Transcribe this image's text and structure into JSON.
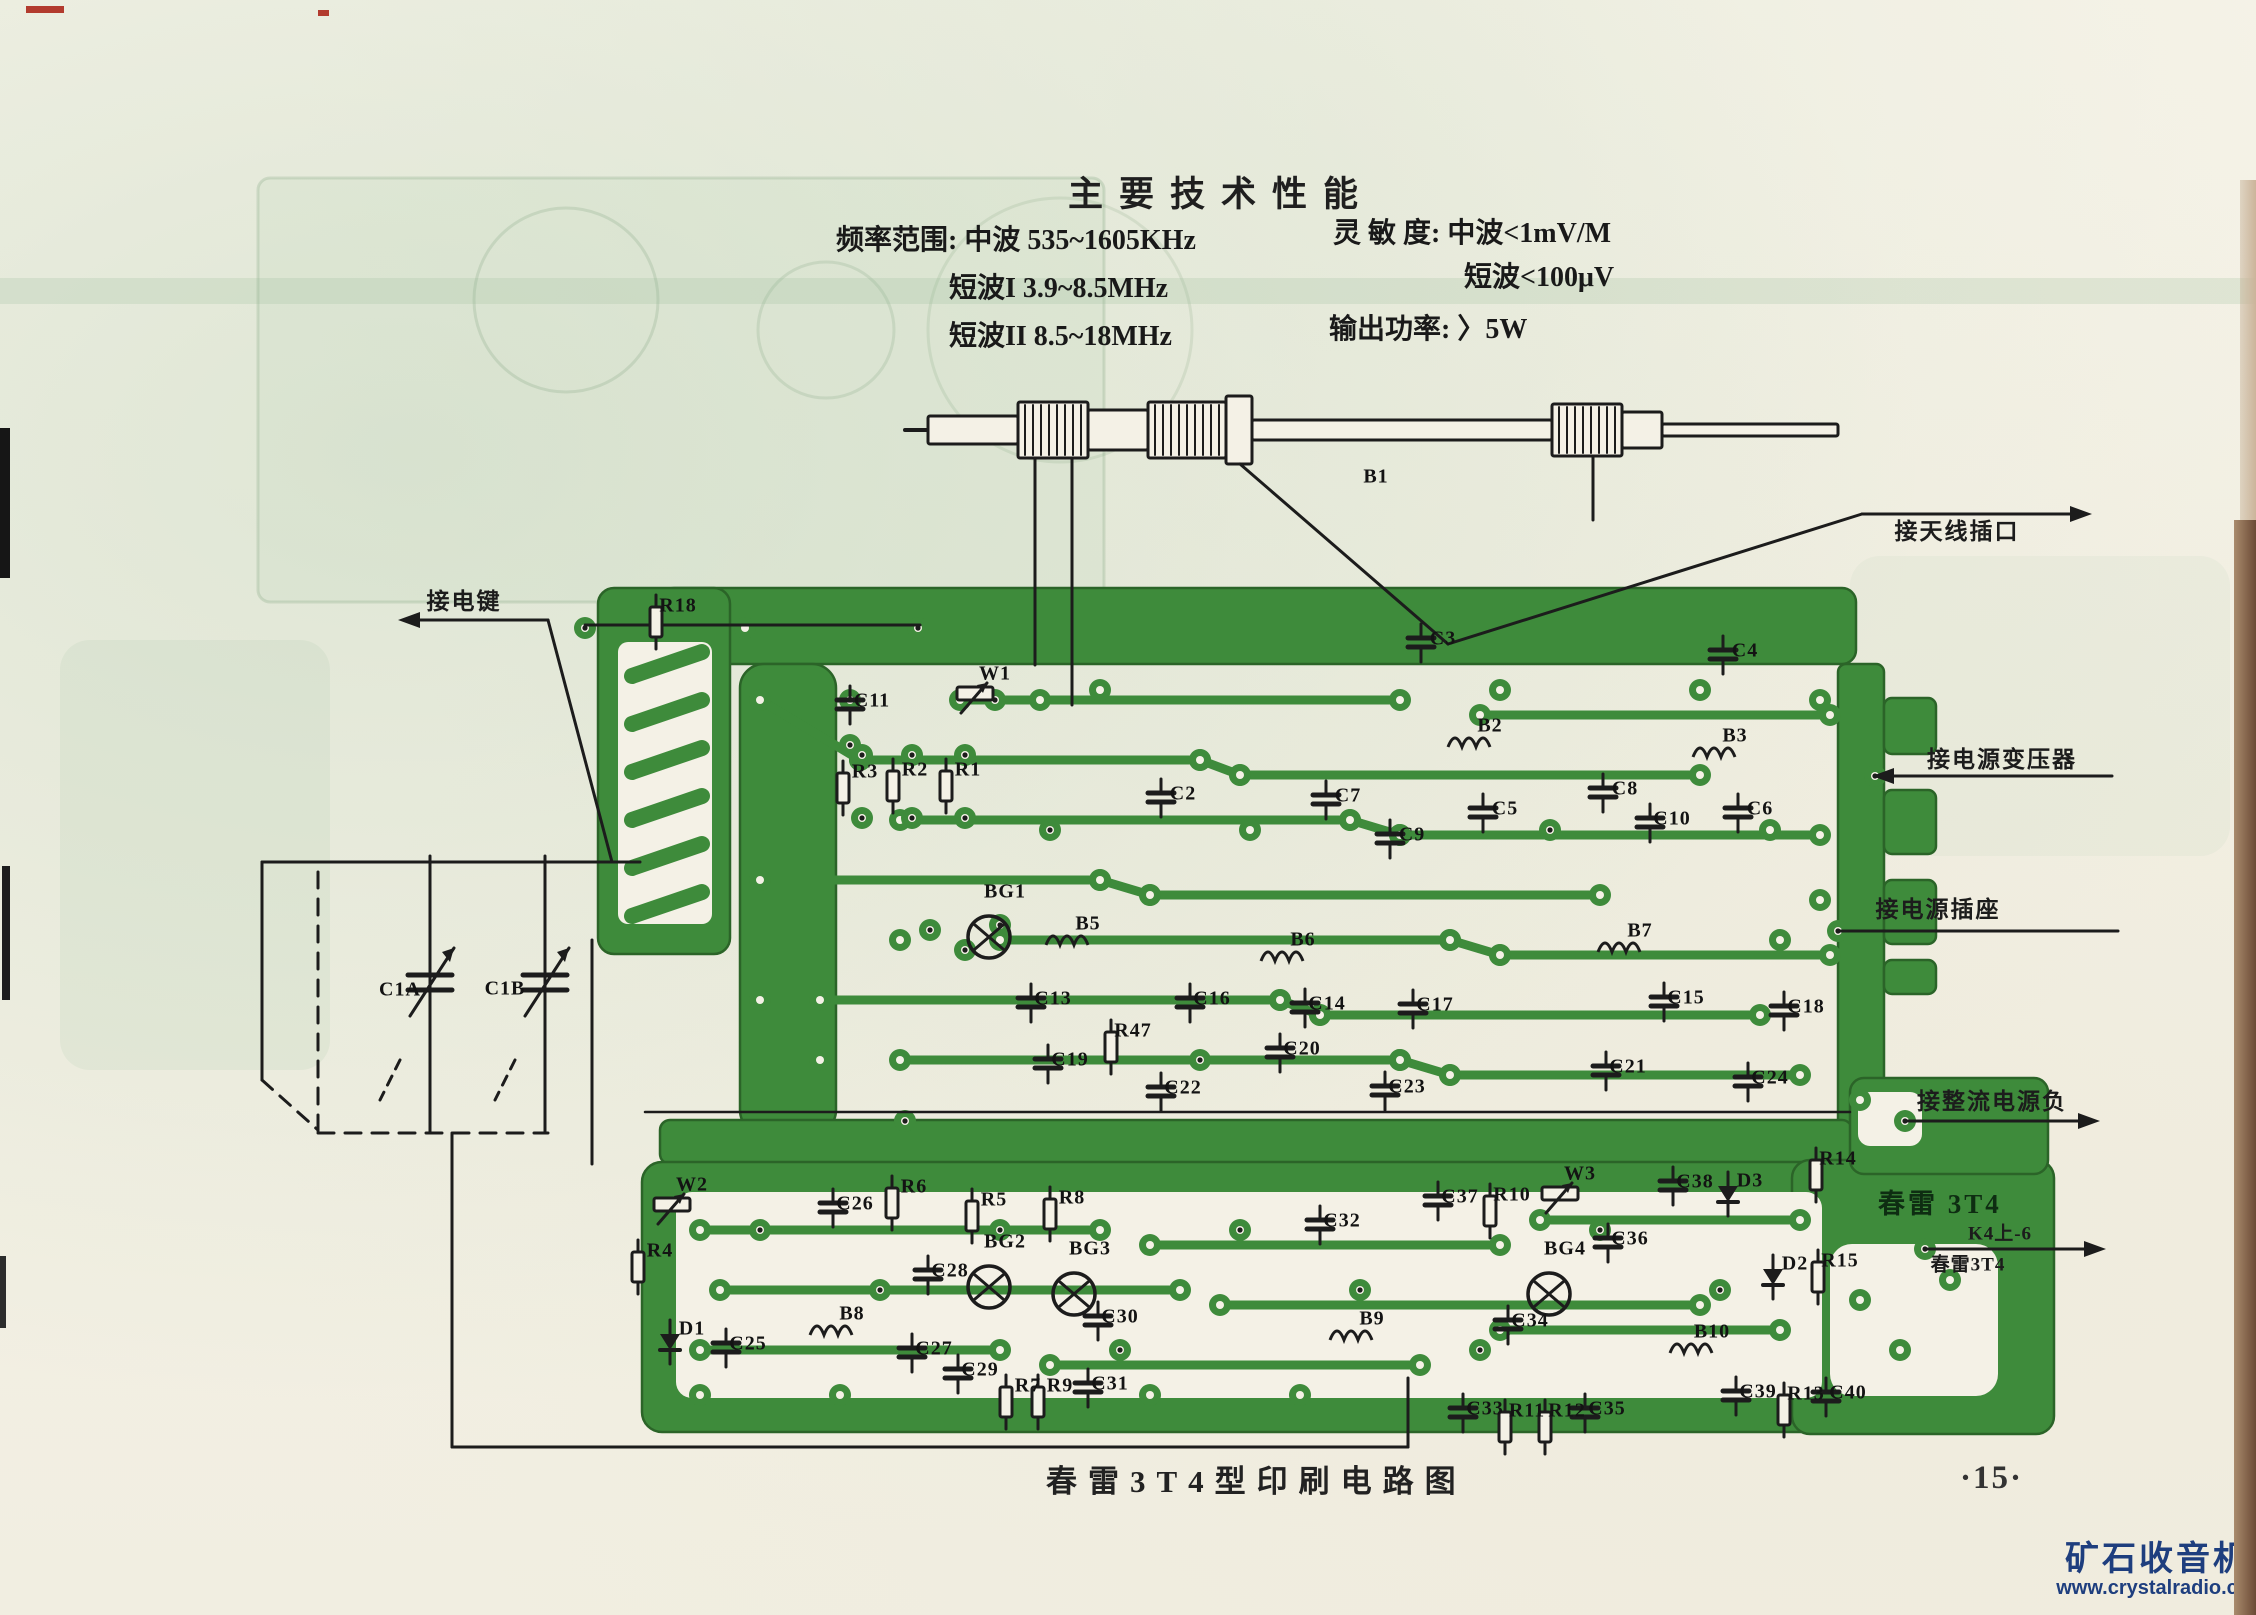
{
  "header": {
    "title": "主要技术性能"
  },
  "specs": {
    "left": [
      {
        "text": "频率范围: 中波 535~1605KHz"
      },
      {
        "text": "短波I 3.9~8.5MHz"
      },
      {
        "text": "短波II 8.5~18MHz"
      }
    ],
    "right": [
      {
        "text": "灵 敏 度: 中波<1mV/M"
      },
      {
        "text": "短波<100μV"
      },
      {
        "text": "输出功率: 〉5W"
      }
    ]
  },
  "board": {
    "silkscreen_text": "春雷 3T4",
    "annotations": [
      {
        "text": "接电键",
        "cx": 464,
        "cy": 599,
        "small": false
      },
      {
        "text": "接天线插口",
        "cx": 1957,
        "cy": 529,
        "small": false
      },
      {
        "text": "接电源变压器",
        "cx": 2002,
        "cy": 757,
        "small": false
      },
      {
        "text": "接电源插座",
        "cx": 1938,
        "cy": 907,
        "small": false
      },
      {
        "text": "接整流电源负",
        "cx": 1992,
        "cy": 1099,
        "small": false
      },
      {
        "text": "K4上-6",
        "cx": 2000,
        "cy": 1232,
        "small": true
      },
      {
        "text": "春雷3T4",
        "cx": 1968,
        "cy": 1263,
        "small": true
      }
    ],
    "component_labels": [
      {
        "id": "R18",
        "x": 678,
        "y": 607
      },
      {
        "id": "C11",
        "x": 872,
        "y": 702
      },
      {
        "id": "W1",
        "x": 995,
        "y": 675
      },
      {
        "id": "R3",
        "x": 865,
        "y": 773
      },
      {
        "id": "R2",
        "x": 915,
        "y": 771
      },
      {
        "id": "R1",
        "x": 968,
        "y": 771
      },
      {
        "id": "BG1",
        "x": 1005,
        "y": 893
      },
      {
        "id": "B1",
        "x": 1376,
        "y": 478
      },
      {
        "id": "C2",
        "x": 1183,
        "y": 795
      },
      {
        "id": "C3",
        "x": 1443,
        "y": 640
      },
      {
        "id": "C4",
        "x": 1745,
        "y": 652
      },
      {
        "id": "B2",
        "x": 1490,
        "y": 727
      },
      {
        "id": "B3",
        "x": 1735,
        "y": 737
      },
      {
        "id": "C7",
        "x": 1348,
        "y": 797
      },
      {
        "id": "C5",
        "x": 1505,
        "y": 810
      },
      {
        "id": "C9",
        "x": 1412,
        "y": 836
      },
      {
        "id": "C8",
        "x": 1625,
        "y": 790
      },
      {
        "id": "C10",
        "x": 1672,
        "y": 820
      },
      {
        "id": "C6",
        "x": 1760,
        "y": 810
      },
      {
        "id": "B5",
        "x": 1088,
        "y": 925
      },
      {
        "id": "B6",
        "x": 1303,
        "y": 941
      },
      {
        "id": "B7",
        "x": 1640,
        "y": 932
      },
      {
        "id": "C13",
        "x": 1053,
        "y": 1000
      },
      {
        "id": "C16",
        "x": 1212,
        "y": 1000
      },
      {
        "id": "C14",
        "x": 1327,
        "y": 1005
      },
      {
        "id": "C17",
        "x": 1435,
        "y": 1006
      },
      {
        "id": "C15",
        "x": 1686,
        "y": 999
      },
      {
        "id": "C18",
        "x": 1806,
        "y": 1008
      },
      {
        "id": "R47",
        "x": 1133,
        "y": 1032
      },
      {
        "id": "C19",
        "x": 1070,
        "y": 1061
      },
      {
        "id": "C20",
        "x": 1302,
        "y": 1050
      },
      {
        "id": "C21",
        "x": 1628,
        "y": 1068
      },
      {
        "id": "C22",
        "x": 1183,
        "y": 1089
      },
      {
        "id": "C23",
        "x": 1407,
        "y": 1088
      },
      {
        "id": "C24",
        "x": 1770,
        "y": 1079
      },
      {
        "id": "C1A",
        "x": 400,
        "y": 991
      },
      {
        "id": "C1B",
        "x": 505,
        "y": 990
      },
      {
        "id": "W2",
        "x": 692,
        "y": 1186
      },
      {
        "id": "R4",
        "x": 660,
        "y": 1252
      },
      {
        "id": "D1",
        "x": 692,
        "y": 1330
      },
      {
        "id": "C25",
        "x": 748,
        "y": 1345
      },
      {
        "id": "C26",
        "x": 855,
        "y": 1205
      },
      {
        "id": "B8",
        "x": 852,
        "y": 1315
      },
      {
        "id": "R6",
        "x": 914,
        "y": 1188
      },
      {
        "id": "R5",
        "x": 994,
        "y": 1201
      },
      {
        "id": "R8",
        "x": 1072,
        "y": 1199
      },
      {
        "id": "BG2",
        "x": 1005,
        "y": 1243
      },
      {
        "id": "BG3",
        "x": 1090,
        "y": 1250
      },
      {
        "id": "C28",
        "x": 950,
        "y": 1272
      },
      {
        "id": "C27",
        "x": 934,
        "y": 1350
      },
      {
        "id": "C29",
        "x": 980,
        "y": 1371
      },
      {
        "id": "R7",
        "x": 1028,
        "y": 1387
      },
      {
        "id": "R9",
        "x": 1060,
        "y": 1387
      },
      {
        "id": "C31",
        "x": 1110,
        "y": 1385
      },
      {
        "id": "C30",
        "x": 1120,
        "y": 1318
      },
      {
        "id": "C32",
        "x": 1342,
        "y": 1222
      },
      {
        "id": "C37",
        "x": 1460,
        "y": 1198
      },
      {
        "id": "R10",
        "x": 1512,
        "y": 1196
      },
      {
        "id": "W3",
        "x": 1580,
        "y": 1175
      },
      {
        "id": "C38",
        "x": 1695,
        "y": 1183
      },
      {
        "id": "D3",
        "x": 1750,
        "y": 1182
      },
      {
        "id": "R14",
        "x": 1838,
        "y": 1160
      },
      {
        "id": "BG4",
        "x": 1565,
        "y": 1250
      },
      {
        "id": "C36",
        "x": 1630,
        "y": 1240
      },
      {
        "id": "B9",
        "x": 1372,
        "y": 1320
      },
      {
        "id": "C34",
        "x": 1530,
        "y": 1322
      },
      {
        "id": "B10",
        "x": 1712,
        "y": 1333
      },
      {
        "id": "D2",
        "x": 1795,
        "y": 1265
      },
      {
        "id": "R15",
        "x": 1840,
        "y": 1262
      },
      {
        "id": "C33",
        "x": 1485,
        "y": 1410
      },
      {
        "id": "R11",
        "x": 1527,
        "y": 1412
      },
      {
        "id": "R12",
        "x": 1567,
        "y": 1412
      },
      {
        "id": "C35",
        "x": 1607,
        "y": 1410
      },
      {
        "id": "C39",
        "x": 1758,
        "y": 1393
      },
      {
        "id": "R13",
        "x": 1806,
        "y": 1395
      },
      {
        "id": "C40",
        "x": 1848,
        "y": 1394
      }
    ]
  },
  "footer": {
    "caption": "春雷3T4型印刷电路图",
    "page_number": "·15·"
  },
  "watermark": {
    "title": "矿石收音机",
    "url": "www.crystalradio.cn"
  },
  "colors": {
    "board_green": "#3e8b3b",
    "board_green_dark": "#2b6428",
    "ink": "#1c1c1c",
    "watermark_navy": "#1e3e7e"
  }
}
